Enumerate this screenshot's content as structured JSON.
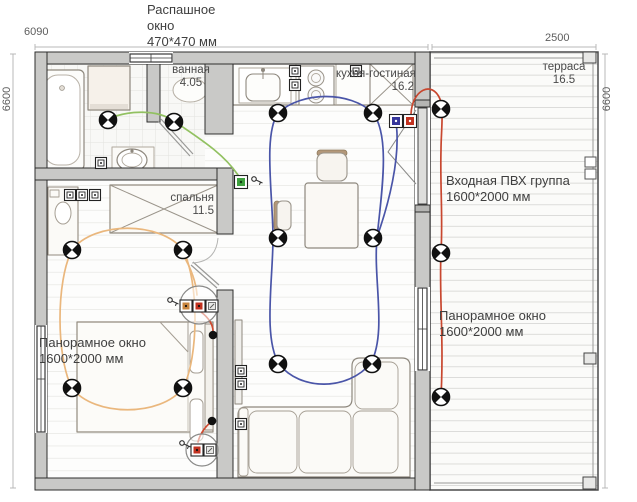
{
  "annotations": {
    "swing_window": {
      "line1": "Распашное",
      "line2": "окно",
      "line3": "470*470 мм"
    },
    "entry_door": {
      "line1": "Входная ПВХ группа",
      "line2": "1600*2000 мм"
    },
    "panoramic_window_bedroom": {
      "line1": "Панорамное окно",
      "line2": "1600*2000 мм"
    },
    "panoramic_window_terrace": {
      "line1": "Панорамное окно",
      "line2": "1600*2000 мм"
    }
  },
  "dimensions": {
    "top_left": "6090",
    "top_right": "2500",
    "left_side": "6600",
    "right_side": "6600"
  },
  "rooms": {
    "bathroom": {
      "name": "ванная",
      "area": "4.05"
    },
    "kitchen_living": {
      "name": "кухня-гостиная",
      "area": "16.2"
    },
    "terrace": {
      "name": "терраса",
      "area": "16.5"
    },
    "bedroom": {
      "name": "спальня",
      "area": "11.5"
    }
  },
  "circuits": {
    "bathroom_wire": "#92c161",
    "kitchen_living_wire": "#4a55a8",
    "bedroom_wire": "#eab77d",
    "sconce_wire": "#d04a30",
    "terrace_wire": "#c8472f"
  },
  "devices": {
    "switch_green": "#3fa03f",
    "switch_blue": "#35359a",
    "switch_red": "#c23220",
    "socket_tan": "#c8853f",
    "socket_red": "#c23220"
  }
}
